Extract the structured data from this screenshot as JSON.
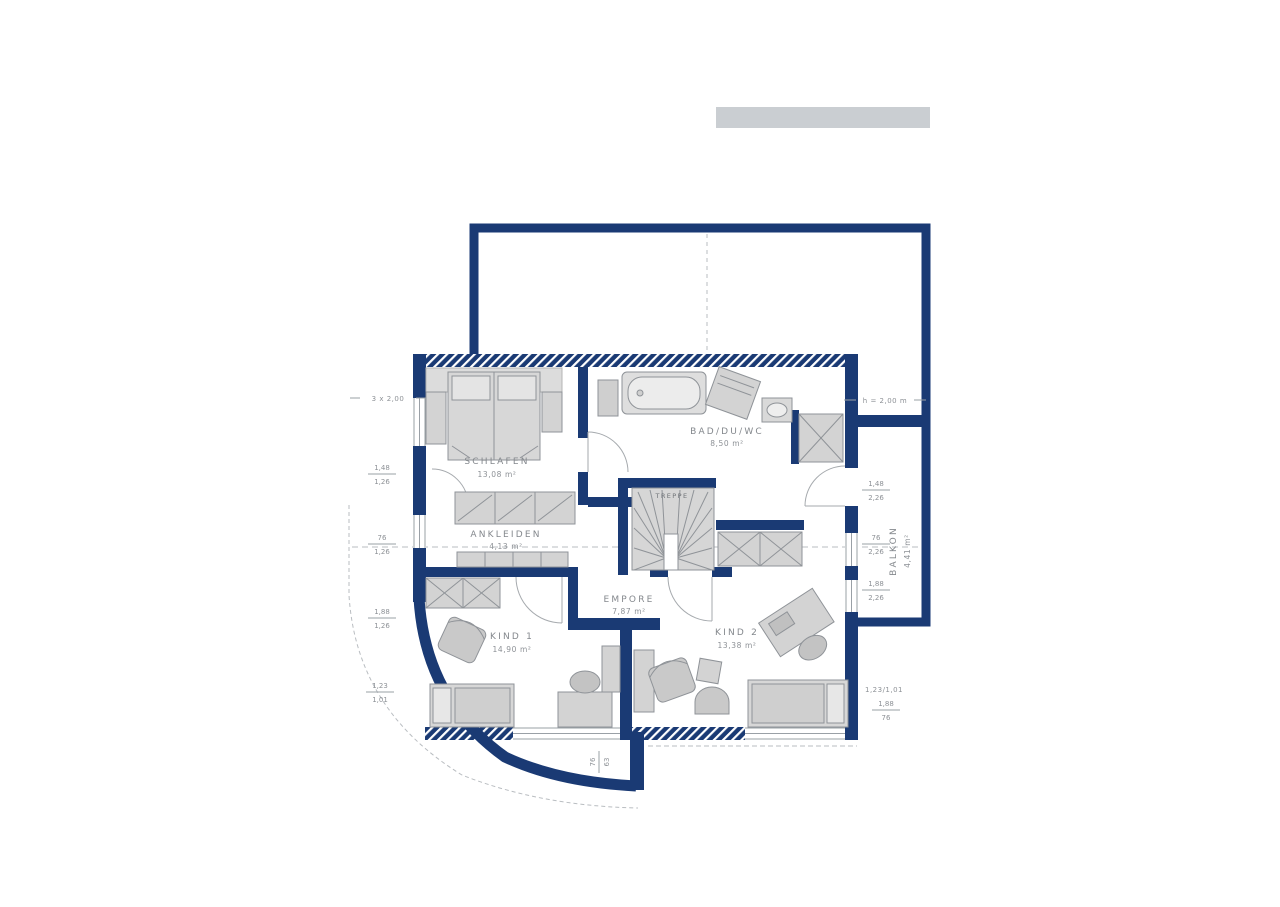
{
  "plan": {
    "rooms": {
      "schlafen": {
        "label": "SCHLAFEN",
        "area": "13,08 m²"
      },
      "ankleiden": {
        "label": "ANKLEIDEN",
        "area": "4,13 m²"
      },
      "bad": {
        "label": "BAD/DU/WC",
        "area": "8,50 m²"
      },
      "treppe": {
        "label": "TREPPE"
      },
      "empore": {
        "label": "EMPORE",
        "area": "7,87 m²"
      },
      "kind1": {
        "label": "KIND 1",
        "area": "14,90 m²"
      },
      "kind2": {
        "label": "KIND 2",
        "area": "13,38 m²"
      },
      "balkon": {
        "label": "BALKON",
        "area": "4,41 m²"
      }
    },
    "annotations": {
      "top_left": "3 x 2,00",
      "height_line": "h = 2,00 m",
      "bottom_right_window": "1,23/1,01"
    },
    "dimensions": {
      "left": [
        {
          "w": "1,48",
          "h": "1,26"
        },
        {
          "w": "76",
          "h": "1,26"
        },
        {
          "w": "1,88",
          "h": "1,26"
        }
      ],
      "right": [
        {
          "w": "1,48",
          "h": "2,26"
        },
        {
          "w": "76",
          "h": "2,26"
        },
        {
          "w": "1,88",
          "h": "2,26"
        }
      ],
      "bottom_right": {
        "w": "1,88",
        "h": "76"
      },
      "bottom_center": {
        "w": "76",
        "h": "63"
      },
      "curve": {
        "w": "1,23",
        "h": "1,01"
      }
    },
    "colors": {
      "wall": "#1a3a74",
      "furniture": "#d3d3d3",
      "furniture_dark": "#c3c3c3",
      "line": "#9aa0a6",
      "label": "#84888d",
      "logo_bar": "#caced2"
    }
  }
}
